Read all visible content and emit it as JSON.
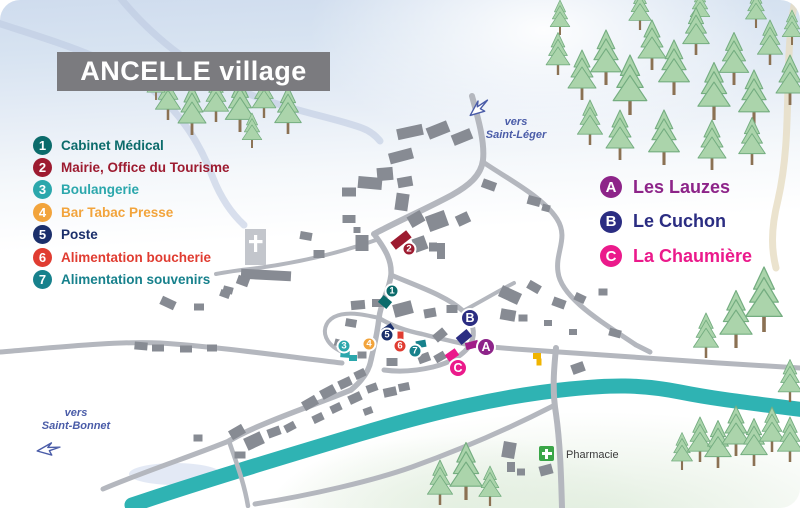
{
  "title": "ANCELLE village",
  "legend_services": {
    "items": [
      {
        "num": "1",
        "label": "Cabinet Médical",
        "color": "#0b6b6b"
      },
      {
        "num": "2",
        "label": "Mairie, Office du Tourisme",
        "color": "#9d1b30"
      },
      {
        "num": "3",
        "label": "Boulangerie",
        "color": "#2ba7ac"
      },
      {
        "num": "4",
        "label": "Bar Tabac Presse",
        "color": "#f2a43c"
      },
      {
        "num": "5",
        "label": "Poste",
        "color": "#1b2f6b"
      },
      {
        "num": "6",
        "label": "Alimentation boucherie",
        "color": "#e03c31"
      },
      {
        "num": "7",
        "label": "Alimentation souvenirs",
        "color": "#17818c"
      }
    ]
  },
  "legend_places": {
    "items": [
      {
        "letter": "A",
        "label": "Les Lauzes",
        "color": "#8d2489"
      },
      {
        "letter": "B",
        "label": "Le Cuchon",
        "color": "#2b2d82"
      },
      {
        "letter": "C",
        "label": "La Chaumière",
        "color": "#eb1a8b"
      }
    ]
  },
  "directions": {
    "saint_leger": {
      "line1": "vers",
      "line2": "Saint-Léger"
    },
    "saint_bonnet": {
      "line1": "vers",
      "line2": "Saint-Bonnet"
    }
  },
  "pharmacy": {
    "label": "Pharmacie",
    "cross_color": "#3aa648"
  },
  "map_markers": {
    "numbers": [
      {
        "label": "1",
        "x": 392,
        "y": 291,
        "color": "#0b6b6b"
      },
      {
        "label": "2",
        "x": 409,
        "y": 249,
        "color": "#9d1b30"
      },
      {
        "label": "3",
        "x": 344,
        "y": 346,
        "color": "#2ba7ac"
      },
      {
        "label": "4",
        "x": 369,
        "y": 344,
        "color": "#f2a43c"
      },
      {
        "label": "5",
        "x": 387,
        "y": 335,
        "color": "#1b2f6b"
      },
      {
        "label": "6",
        "x": 400,
        "y": 346,
        "color": "#e03c31"
      },
      {
        "label": "7",
        "x": 415,
        "y": 351,
        "color": "#17818c"
      }
    ],
    "letters": [
      {
        "label": "A",
        "x": 486,
        "y": 347,
        "color": "#8d2489"
      },
      {
        "label": "B",
        "x": 470,
        "y": 318,
        "color": "#2b2d82"
      },
      {
        "label": "C",
        "x": 458,
        "y": 368,
        "color": "#eb1a8b"
      }
    ]
  },
  "colors": {
    "river": "#2fb3b3",
    "road": "#b4b7be",
    "building": "#878b93",
    "church": "#c3c6cc",
    "title_bg": "#7b7b7f",
    "direction_text": "#4a5ca8"
  }
}
